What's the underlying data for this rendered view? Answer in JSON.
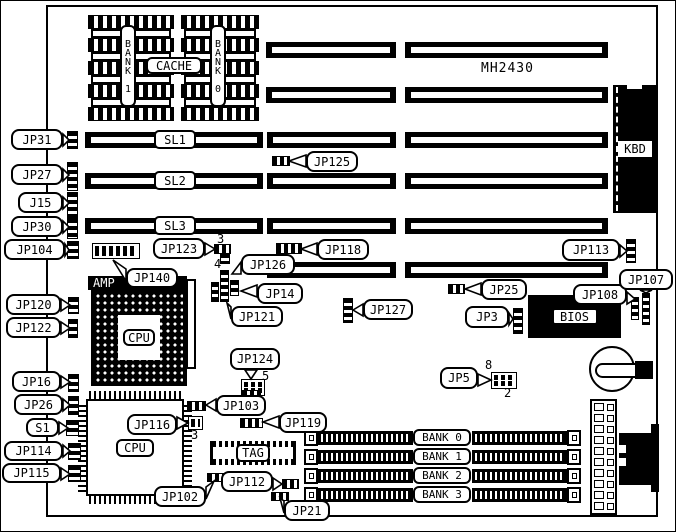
{
  "static_labels": {
    "model": "MH2430",
    "amp": "AMP",
    "cpu_socket": "CPU",
    "cpu_chip": "CPU",
    "tag": "TAG",
    "bios": "BIOS",
    "kbd": "KBD",
    "cache": "CACHE",
    "bank1_column": "BANK 1",
    "bank0_column": "BANK 0"
  },
  "components": {
    "slots": [
      {
        "y": 41,
        "segs": [
          {
            "x": 265,
            "w": 130
          },
          {
            "x": 404,
            "w": 203
          }
        ]
      },
      {
        "y": 86,
        "segs": [
          {
            "x": 265,
            "w": 130
          },
          {
            "x": 404,
            "w": 203
          }
        ]
      },
      {
        "y": 131,
        "segs": [
          {
            "x": 84,
            "w": 178,
            "label": "SL1"
          },
          {
            "x": 266,
            "w": 129
          },
          {
            "x": 404,
            "w": 203
          }
        ]
      },
      {
        "y": 172,
        "segs": [
          {
            "x": 84,
            "w": 178,
            "label": "SL2"
          },
          {
            "x": 266,
            "w": 129
          },
          {
            "x": 404,
            "w": 203
          }
        ]
      },
      {
        "y": 217,
        "segs": [
          {
            "x": 84,
            "w": 178,
            "label": "SL3"
          },
          {
            "x": 266,
            "w": 129
          },
          {
            "x": 404,
            "w": 203
          }
        ]
      },
      {
        "y": 261,
        "segs": [
          {
            "x": 266,
            "w": 129
          },
          {
            "x": 404,
            "w": 203
          }
        ]
      }
    ],
    "chips": {
      "x_groups": [
        {
          "x": 87,
          "w": 86
        },
        {
          "x": 180,
          "w": 78
        }
      ],
      "top": 14,
      "striped_h": 14,
      "plain_h": 9,
      "rows": 9
    },
    "callouts": [
      {
        "id": "jp31",
        "label": "JP31",
        "x": 10,
        "y": 128,
        "w": 52,
        "h": 21,
        "tx": 68,
        "ty": 139
      },
      {
        "id": "jp27",
        "label": "JP27",
        "x": 10,
        "y": 163,
        "w": 52,
        "h": 21,
        "tx": 68,
        "ty": 174
      },
      {
        "id": "j15",
        "label": "J15",
        "x": 17,
        "y": 191,
        "w": 45,
        "h": 21,
        "tx": 68,
        "ty": 202
      },
      {
        "id": "jp30",
        "label": "JP30",
        "x": 10,
        "y": 215,
        "w": 52,
        "h": 21,
        "tx": 68,
        "ty": 226
      },
      {
        "id": "jp104",
        "label": "JP104",
        "x": 3,
        "y": 238,
        "w": 61,
        "h": 21,
        "tx": 68,
        "ty": 249
      },
      {
        "id": "jp120",
        "label": "JP120",
        "x": 5,
        "y": 293,
        "w": 55,
        "h": 21,
        "tx": 69,
        "ty": 304
      },
      {
        "id": "jp122",
        "label": "JP122",
        "x": 5,
        "y": 316,
        "w": 55,
        "h": 21,
        "tx": 69,
        "ty": 327
      },
      {
        "id": "jp16",
        "label": "JP16",
        "x": 11,
        "y": 370,
        "w": 49,
        "h": 21,
        "tx": 69,
        "ty": 381
      },
      {
        "id": "jp26",
        "label": "JP26",
        "x": 13,
        "y": 393,
        "w": 49,
        "h": 21,
        "tx": 69,
        "ty": 404
      },
      {
        "id": "s1",
        "label": "S1",
        "x": 25,
        "y": 417,
        "w": 33,
        "h": 19,
        "tx": 67,
        "ty": 427
      },
      {
        "id": "jp114",
        "label": "JP114",
        "x": 3,
        "y": 440,
        "w": 59,
        "h": 20,
        "tx": 69,
        "ty": 450
      },
      {
        "id": "jp115",
        "label": "JP115",
        "x": 1,
        "y": 462,
        "w": 59,
        "h": 20,
        "tx": 69,
        "ty": 473
      },
      {
        "id": "jp125",
        "label": "JP125",
        "x": 305,
        "y": 150,
        "w": 52,
        "h": 21,
        "tx": 288,
        "ty": 160
      },
      {
        "id": "jp123",
        "label": "JP123",
        "x": 152,
        "y": 237,
        "w": 52,
        "h": 21,
        "tx": 214,
        "ty": 248
      },
      {
        "id": "jp118",
        "label": "JP118",
        "x": 316,
        "y": 238,
        "w": 52,
        "h": 21,
        "tx": 300,
        "ty": 248
      },
      {
        "id": "jp113",
        "label": "JP113",
        "x": 561,
        "y": 238,
        "w": 58,
        "h": 22,
        "tx": 626,
        "ty": 250
      },
      {
        "id": "jp126",
        "label": "JP126",
        "x": 240,
        "y": 253,
        "w": 54,
        "h": 21,
        "tx": 231,
        "ty": 273
      },
      {
        "id": "jp14",
        "label": "JP14",
        "x": 256,
        "y": 282,
        "w": 46,
        "h": 21,
        "tx": 240,
        "ty": 290
      },
      {
        "id": "jp140",
        "label": "JP140",
        "x": 125,
        "y": 267,
        "w": 52,
        "h": 20,
        "tx": 112,
        "ty": 259
      },
      {
        "id": "jp121",
        "label": "JP121",
        "x": 230,
        "y": 305,
        "w": 52,
        "h": 21,
        "tx": 226,
        "ty": 302
      },
      {
        "id": "jp127",
        "label": "JP127",
        "x": 362,
        "y": 298,
        "w": 50,
        "h": 21,
        "tx": 352,
        "ty": 309
      },
      {
        "id": "jp25",
        "label": "JP25",
        "x": 480,
        "y": 278,
        "w": 46,
        "h": 21,
        "tx": 464,
        "ty": 288
      },
      {
        "id": "jp3",
        "label": "JP3",
        "x": 464,
        "y": 305,
        "w": 44,
        "h": 22,
        "tx": 512,
        "ty": 318
      },
      {
        "id": "jp108",
        "label": "JP108",
        "x": 572,
        "y": 283,
        "w": 54,
        "h": 21,
        "tx": 634,
        "ty": 298
      },
      {
        "id": "jp107",
        "label": "JP107",
        "x": 618,
        "y": 268,
        "w": 54,
        "h": 21,
        "tx": 645,
        "ty": 292
      },
      {
        "id": "jp124",
        "label": "JP124",
        "x": 229,
        "y": 347,
        "w": 50,
        "h": 22,
        "tx": 250,
        "ty": 378
      },
      {
        "id": "jp5",
        "label": "JP5",
        "x": 439,
        "y": 366,
        "w": 38,
        "h": 22,
        "tx": 490,
        "ty": 379
      },
      {
        "id": "jp103",
        "label": "JP103",
        "x": 215,
        "y": 394,
        "w": 50,
        "h": 21,
        "tx": 205,
        "ty": 404
      },
      {
        "id": "jp119",
        "label": "JP119",
        "x": 278,
        "y": 411,
        "w": 48,
        "h": 21,
        "tx": 262,
        "ty": 421
      },
      {
        "id": "jp116",
        "label": "JP116",
        "x": 126,
        "y": 413,
        "w": 50,
        "h": 21,
        "tx": 187,
        "ty": 422
      },
      {
        "id": "jp102",
        "label": "JP102",
        "x": 153,
        "y": 485,
        "w": 52,
        "h": 21,
        "tx": 213,
        "ty": 480
      },
      {
        "id": "jp112",
        "label": "JP112",
        "x": 220,
        "y": 470,
        "w": 52,
        "h": 21,
        "tx": 281,
        "ty": 483
      },
      {
        "id": "jp21",
        "label": "JP21",
        "x": 283,
        "y": 499,
        "w": 46,
        "h": 21,
        "tx": 279,
        "ty": 497
      }
    ],
    "jumpers": [
      {
        "id": "jp31",
        "t": "v",
        "x": 66,
        "y": 130,
        "w": 11,
        "h": 18
      },
      {
        "id": "jp27",
        "t": "v",
        "x": 66,
        "y": 161,
        "w": 11,
        "h": 29
      },
      {
        "id": "j15",
        "t": "v",
        "x": 66,
        "y": 191,
        "w": 11,
        "h": 26
      },
      {
        "id": "jp30",
        "t": "v",
        "x": 66,
        "y": 217,
        "w": 11,
        "h": 21
      },
      {
        "id": "jp104",
        "t": "v",
        "x": 66,
        "y": 240,
        "w": 12,
        "h": 18
      },
      {
        "id": "jp120",
        "t": "v",
        "x": 67,
        "y": 296,
        "w": 11,
        "h": 17
      },
      {
        "id": "jp122",
        "t": "v",
        "x": 67,
        "y": 318,
        "w": 10,
        "h": 19
      },
      {
        "id": "jp16",
        "t": "v",
        "x": 67,
        "y": 373,
        "w": 11,
        "h": 18
      },
      {
        "id": "jp26",
        "t": "v",
        "x": 67,
        "y": 395,
        "w": 11,
        "h": 19
      },
      {
        "id": "s1",
        "t": "v",
        "x": 65,
        "y": 419,
        "w": 13,
        "h": 16
      },
      {
        "id": "jp114",
        "t": "v",
        "x": 67,
        "y": 442,
        "w": 13,
        "h": 17
      },
      {
        "id": "jp115",
        "t": "v",
        "x": 67,
        "y": 464,
        "w": 13,
        "h": 17
      },
      {
        "id": "jp125",
        "t": "h",
        "x": 271,
        "y": 155,
        "w": 18,
        "h": 10
      },
      {
        "id": "jp123-a",
        "t": "h",
        "x": 213,
        "y": 243,
        "w": 17,
        "h": 10
      },
      {
        "id": "jp123-b",
        "t": "v",
        "x": 219,
        "y": 252,
        "w": 10,
        "h": 11
      },
      {
        "id": "jp118",
        "t": "h",
        "x": 275,
        "y": 242,
        "w": 26,
        "h": 11
      },
      {
        "id": "jp113",
        "t": "v",
        "x": 625,
        "y": 238,
        "w": 10,
        "h": 24
      },
      {
        "id": "jp126-a",
        "t": "v",
        "x": 210,
        "y": 281,
        "w": 8,
        "h": 20
      },
      {
        "id": "jp126-b",
        "t": "v",
        "x": 219,
        "y": 269,
        "w": 9,
        "h": 32
      },
      {
        "id": "jp126-c",
        "t": "v",
        "x": 229,
        "y": 279,
        "w": 9,
        "h": 16
      },
      {
        "id": "jp140",
        "t": "g",
        "x": 91,
        "y": 242,
        "w": 48,
        "h": 16
      },
      {
        "id": "jp127",
        "t": "v",
        "x": 342,
        "y": 297,
        "w": 10,
        "h": 25
      },
      {
        "id": "jp25",
        "t": "h",
        "x": 447,
        "y": 283,
        "w": 17,
        "h": 10
      },
      {
        "id": "jp3",
        "t": "v",
        "x": 512,
        "y": 307,
        "w": 10,
        "h": 26
      },
      {
        "id": "jp108",
        "t": "v",
        "x": 630,
        "y": 296,
        "w": 8,
        "h": 23
      },
      {
        "id": "jp107",
        "t": "v",
        "x": 641,
        "y": 292,
        "w": 8,
        "h": 32
      },
      {
        "id": "jp124",
        "t": "g",
        "x": 240,
        "y": 378,
        "w": 24,
        "h": 17
      },
      {
        "id": "jp5",
        "t": "g",
        "x": 490,
        "y": 371,
        "w": 26,
        "h": 17
      },
      {
        "id": "jp103-a",
        "t": "h",
        "x": 186,
        "y": 400,
        "w": 19,
        "h": 10
      },
      {
        "id": "jp103-b",
        "t": "h",
        "x": 241,
        "y": 389,
        "w": 19,
        "h": 8
      },
      {
        "id": "jp119",
        "t": "h",
        "x": 239,
        "y": 417,
        "w": 23,
        "h": 10
      },
      {
        "id": "jp116",
        "t": "g",
        "x": 187,
        "y": 415,
        "w": 15,
        "h": 14
      },
      {
        "id": "jp102",
        "t": "h",
        "x": 206,
        "y": 472,
        "w": 17,
        "h": 9
      },
      {
        "id": "jp112",
        "t": "h",
        "x": 281,
        "y": 478,
        "w": 17,
        "h": 10
      },
      {
        "id": "jp21",
        "t": "h",
        "x": 270,
        "y": 491,
        "w": 18,
        "h": 9
      }
    ],
    "pin_numbers": [
      {
        "text": "3",
        "x": 216,
        "y": 231
      },
      {
        "text": "4",
        "x": 213,
        "y": 256
      },
      {
        "text": "5",
        "x": 261,
        "y": 368
      },
      {
        "text": "8",
        "x": 484,
        "y": 357
      },
      {
        "text": "2",
        "x": 503,
        "y": 385
      },
      {
        "text": "3",
        "x": 190,
        "y": 427
      }
    ],
    "banks": {
      "ys": [
        429,
        448,
        467,
        486
      ],
      "labels": [
        "BANK 0",
        "BANK 1",
        "BANK 2",
        "BANK 3"
      ]
    },
    "power": {
      "cells": 10
    }
  }
}
